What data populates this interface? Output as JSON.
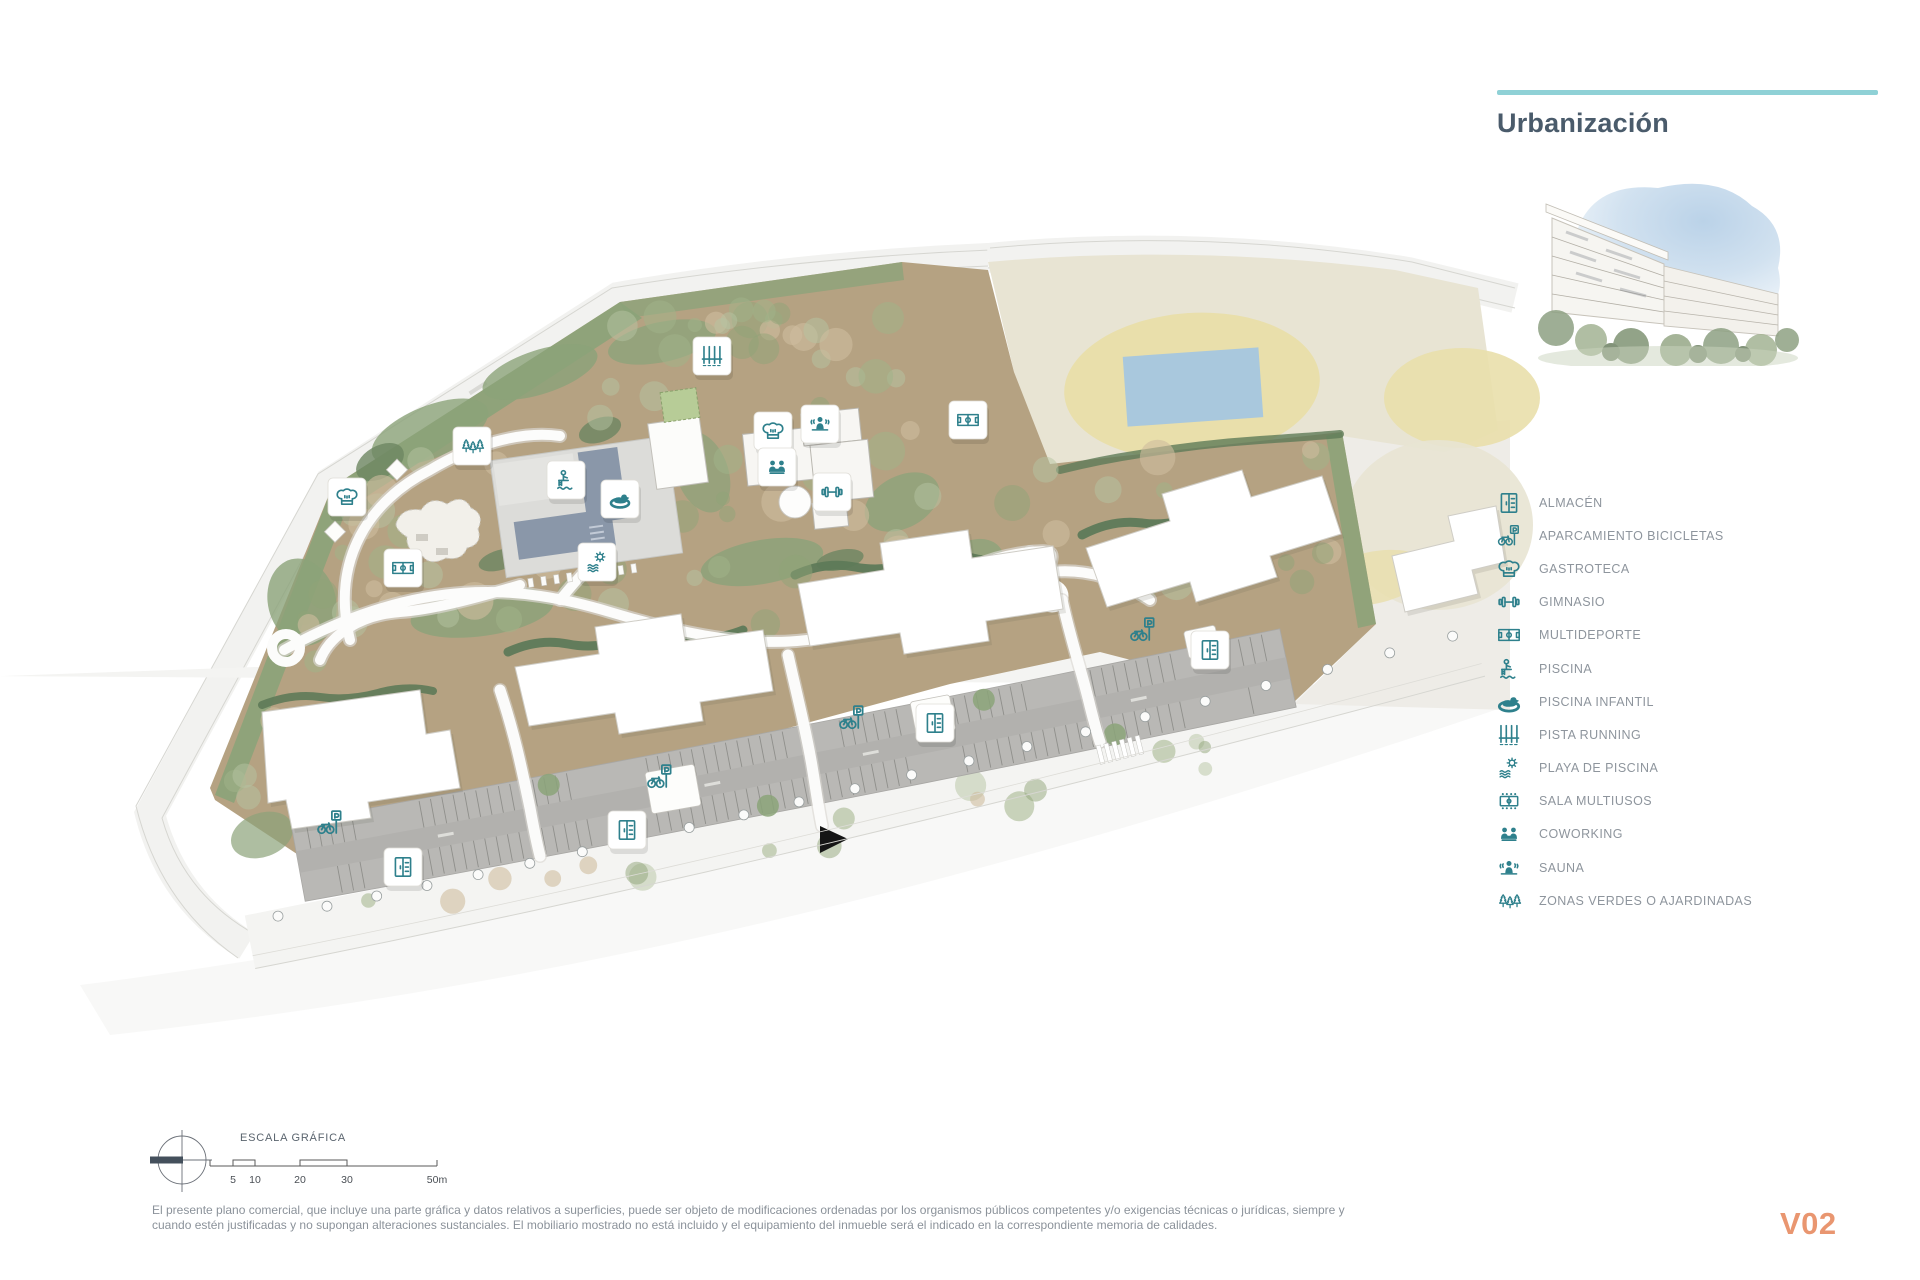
{
  "header": {
    "title": "Urbanización"
  },
  "legend": {
    "items": [
      {
        "icon": "almacen",
        "label": "ALMACÉN"
      },
      {
        "icon": "aparcamiento-bicicletas",
        "label": "APARCAMIENTO BICICLETAS"
      },
      {
        "icon": "gastroteca",
        "label": "GASTROTECA"
      },
      {
        "icon": "gimnasio",
        "label": "GIMNASIO"
      },
      {
        "icon": "multideporte",
        "label": "MULTIDEPORTE"
      },
      {
        "icon": "piscina",
        "label": "PISCINA"
      },
      {
        "icon": "piscina-infantil",
        "label": "PISCINA INFANTIL"
      },
      {
        "icon": "pista-running",
        "label": "PISTA RUNNING"
      },
      {
        "icon": "playa-de-piscina",
        "label": "PLAYA DE PISCINA"
      },
      {
        "icon": "sala-multiusos",
        "label": "SALA MULTIUSOS"
      },
      {
        "icon": "coworking",
        "label": "COWORKING"
      },
      {
        "icon": "sauna",
        "label": "SAUNA"
      },
      {
        "icon": "zonas-verdes",
        "label": "ZONAS VERDES O AJARDINADAS"
      }
    ]
  },
  "scale_bar": {
    "title": "ESCALA GRÁFICA",
    "tick_labels": [
      "5",
      "10",
      "20",
      "30",
      "50m"
    ]
  },
  "disclaimer": {
    "line1": "El presente plano comercial, que incluye una parte gráfica y datos relativos a superficies, puede ser objeto de modificaciones ordenadas por los organismos públicos competentes y/o exigencias técnicas o jurídicas, siempre y",
    "line2": "cuando estén justificadas y no supongan alteraciones sustanciales. El mobiliario mostrado no está incluido y el equipamiento del inmueble será el indicado en la correspondiente memoria de calidades."
  },
  "footer": {
    "version": "V02"
  },
  "plan": {
    "markers": [
      {
        "icon": "gastroteca",
        "x": 347,
        "y": 497,
        "boxed": true
      },
      {
        "icon": "multideporte",
        "x": 403,
        "y": 568,
        "boxed": true
      },
      {
        "icon": "zonas-verdes",
        "x": 472,
        "y": 446,
        "boxed": true
      },
      {
        "icon": "pista-running",
        "x": 712,
        "y": 356,
        "boxed": true
      },
      {
        "icon": "piscina",
        "x": 566,
        "y": 480,
        "boxed": true
      },
      {
        "icon": "piscina-infantil",
        "x": 620,
        "y": 499,
        "boxed": true
      },
      {
        "icon": "playa-de-piscina",
        "x": 597,
        "y": 562,
        "boxed": true
      },
      {
        "icon": "gastroteca",
        "x": 773,
        "y": 431,
        "boxed": true
      },
      {
        "icon": "sauna",
        "x": 820,
        "y": 424,
        "boxed": true
      },
      {
        "icon": "coworking",
        "x": 777,
        "y": 467,
        "boxed": true
      },
      {
        "icon": "gimnasio",
        "x": 832,
        "y": 492,
        "boxed": true
      },
      {
        "icon": "multideporte",
        "x": 968,
        "y": 420,
        "boxed": true
      },
      {
        "icon": "almacen",
        "x": 403,
        "y": 867,
        "boxed": true
      },
      {
        "icon": "almacen",
        "x": 627,
        "y": 830,
        "boxed": true
      },
      {
        "icon": "almacen",
        "x": 935,
        "y": 723,
        "boxed": true
      },
      {
        "icon": "almacen",
        "x": 1210,
        "y": 650,
        "boxed": true
      },
      {
        "icon": "aparcamiento-bicicletas",
        "x": 330,
        "y": 823,
        "boxed": false
      },
      {
        "icon": "aparcamiento-bicicletas",
        "x": 660,
        "y": 777,
        "boxed": false
      },
      {
        "icon": "aparcamiento-bicicletas",
        "x": 852,
        "y": 718,
        "boxed": false
      },
      {
        "icon": "aparcamiento-bicicletas",
        "x": 1143,
        "y": 630,
        "boxed": false
      }
    ]
  },
  "colors": {
    "accent_teal": "#2e808c",
    "rule_teal": "#8fd1d6",
    "title_text": "#4a5b6b",
    "legend_text": "#8e959d",
    "version_text": "#e99670"
  }
}
